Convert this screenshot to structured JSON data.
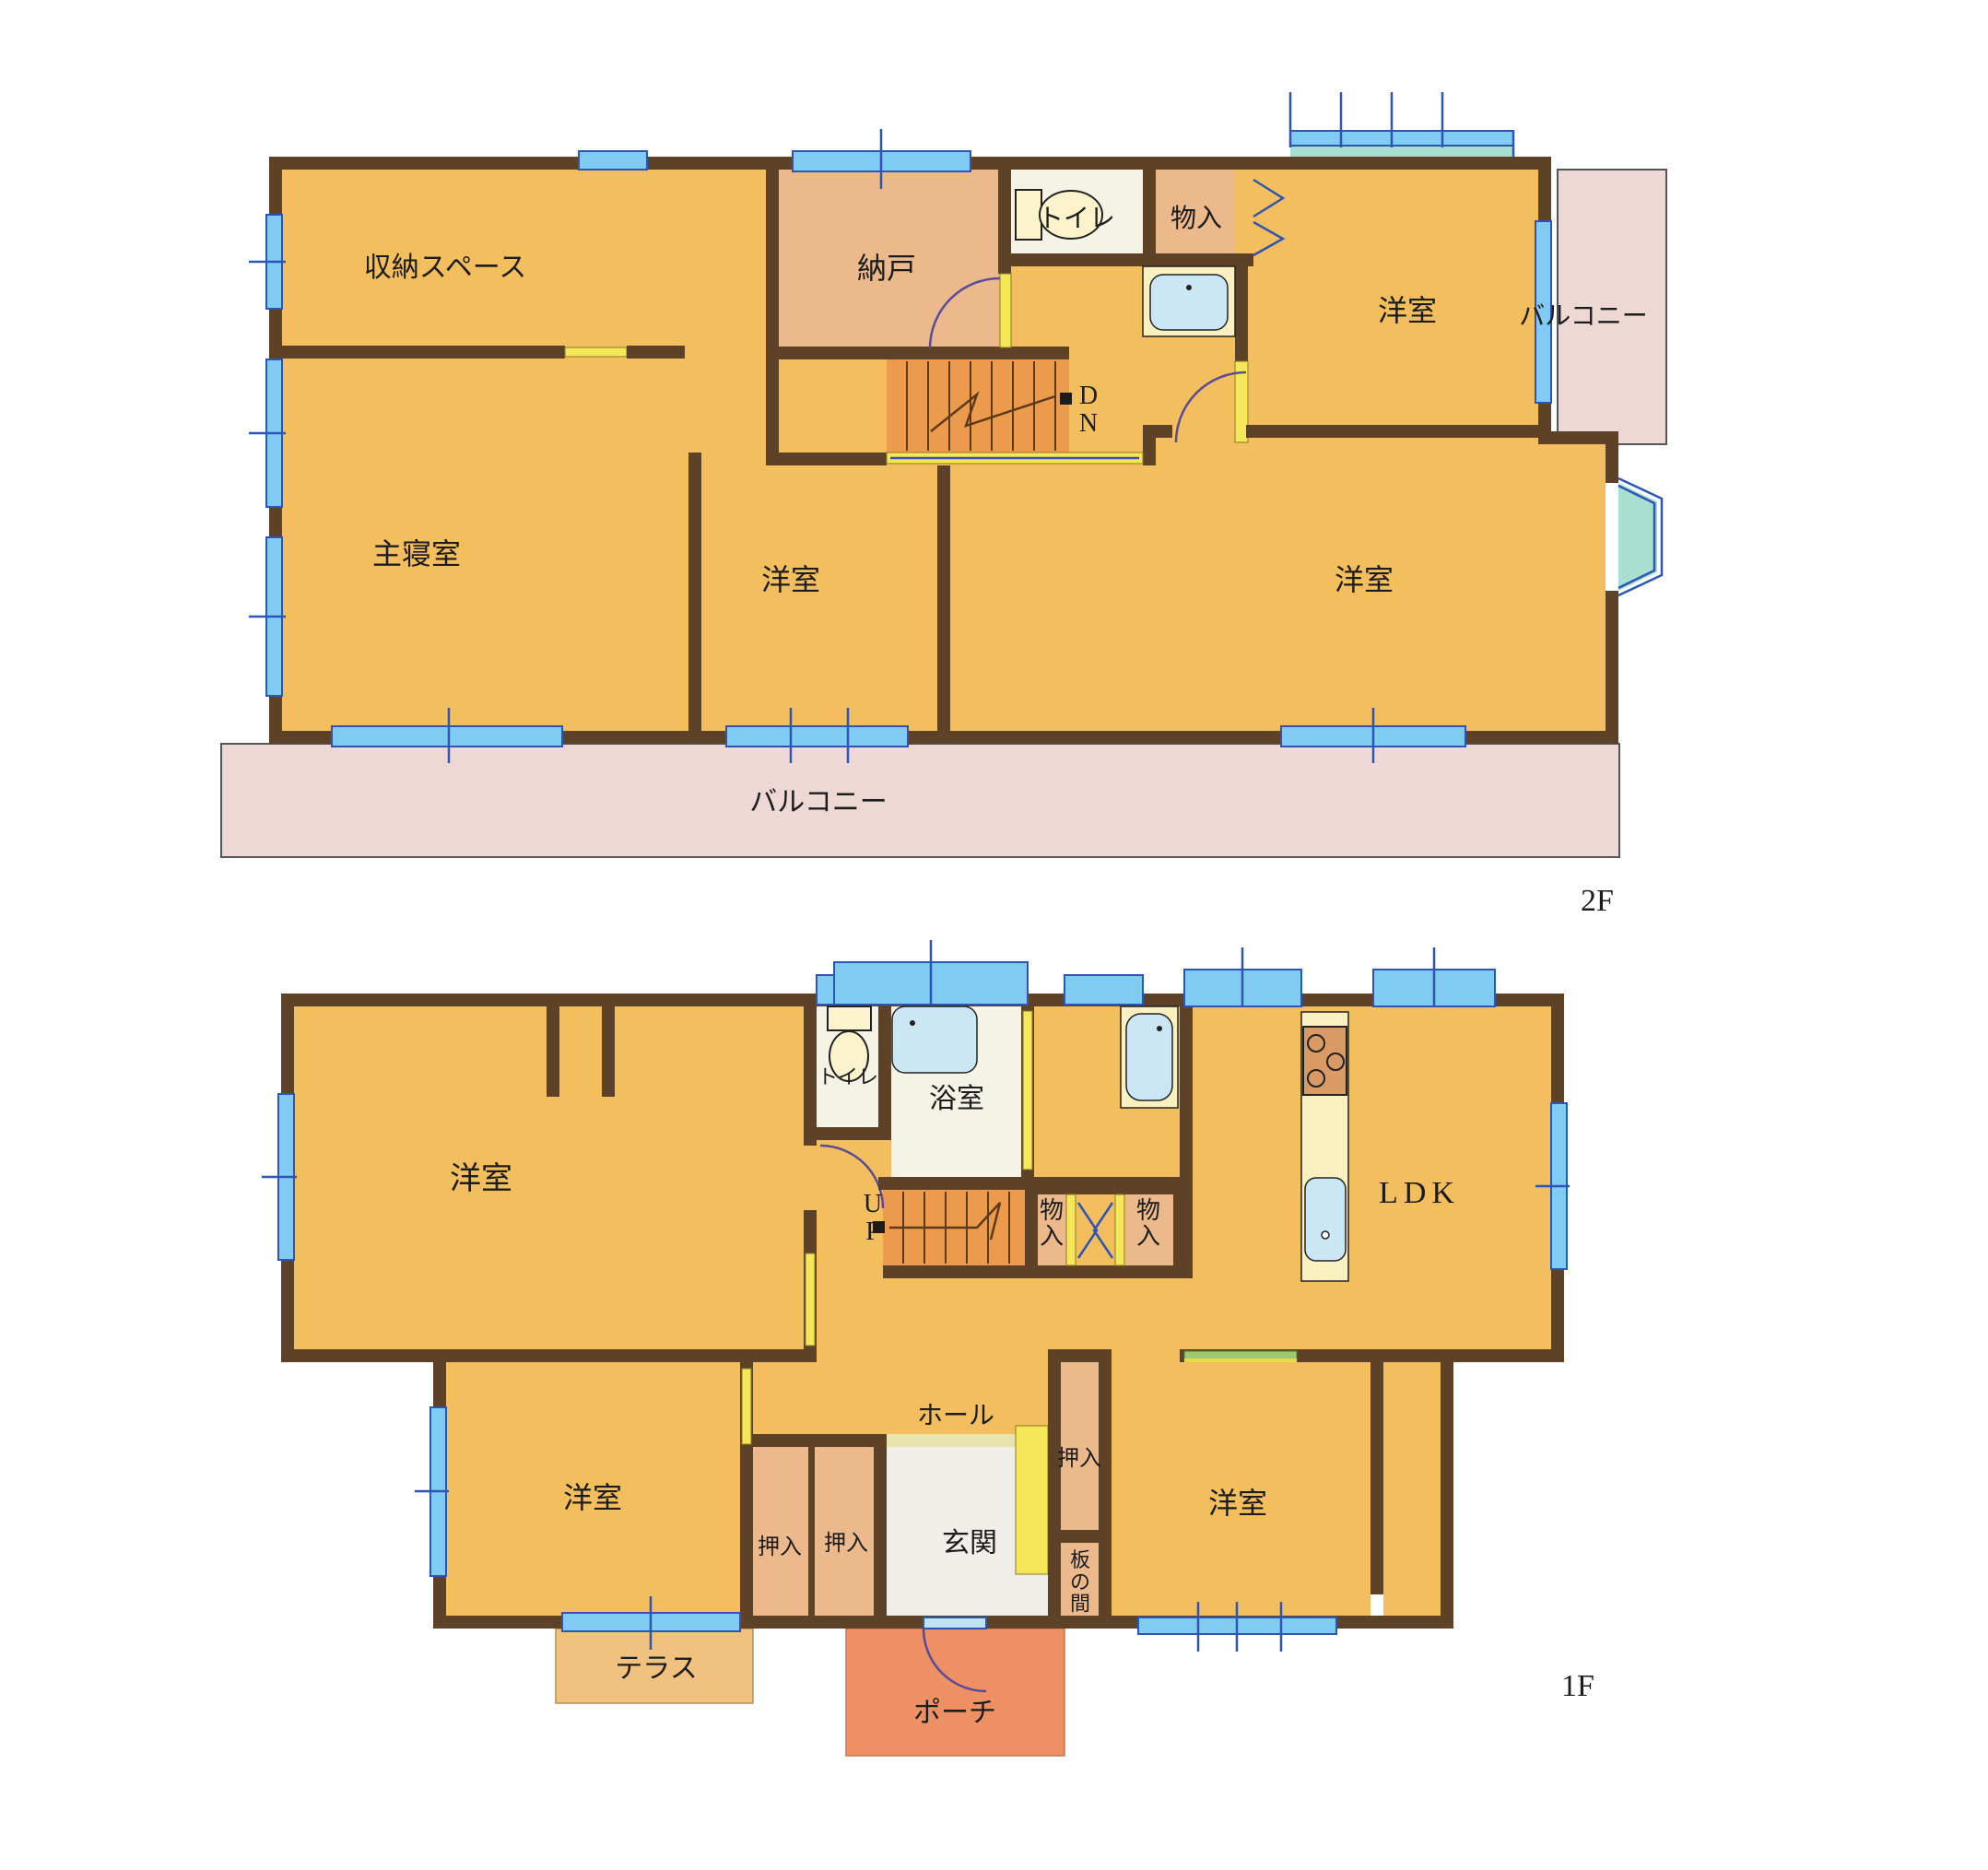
{
  "floor2": {
    "label": "2F",
    "stairs_down": "DN",
    "rooms": {
      "storage_space": "収納スペース",
      "nando": "納戸",
      "toilet": "トイレ",
      "monoire": "物入",
      "bedroom_tr": "洋室",
      "balcony_right": "バルコニー",
      "master_bedroom": "主寝室",
      "bedroom_center": "洋室",
      "bedroom_br": "洋室",
      "balcony_bottom": "バルコニー"
    }
  },
  "floor1": {
    "label": "1F",
    "stairs_up": "UP",
    "rooms": {
      "bedroom_main": "洋室",
      "toilet": "トイレ",
      "bath": "浴室",
      "ldk": "LDK",
      "monoire_a": "物入",
      "monoire_b": "物入",
      "hall": "ホール",
      "genkan": "玄関",
      "oshiire_a": "押入",
      "oshiire_b": "押入",
      "oshiire_c": "押入",
      "itanoma": "板の間",
      "bedroom_sw": "洋室",
      "bedroom_se": "洋室",
      "terrace": "テラス",
      "porch": "ポーチ"
    }
  },
  "colors": {
    "wall": "#5e4227",
    "floor_orange": "#f3be5e",
    "closet_tan": "#ebb98b",
    "stair_orange": "#ec9b4d",
    "balcony_pink": "#edd8d5",
    "terrace": "#f1c180",
    "porch": "#ed9164",
    "window_blue": "#7fcbf2",
    "frame_blue": "#2f55b4",
    "bay_teal": "#a7dfd1",
    "door_yellow": "#f5e65a",
    "water_blue": "#cbe7f5",
    "text": "#1c1c1c"
  }
}
